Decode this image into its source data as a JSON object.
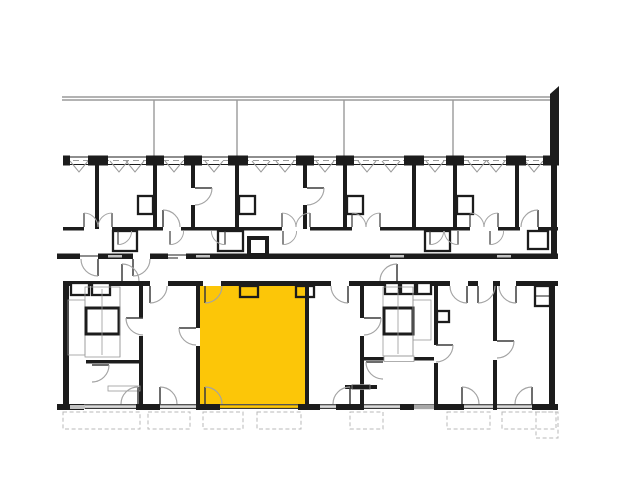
{
  "colors": {
    "wall": "#1c1c1c",
    "line_gray": "#9a9a9a",
    "dash_gray": "#b9b9b9",
    "highlight": "#fcc608",
    "sill": "#c2c2c2",
    "background": "#ffffff"
  },
  "plan": {
    "type": "architectural-floor-plan",
    "upper_building": {
      "units_visible": 8,
      "elements": [
        "balcony-row-with-railing",
        "window-band-with-piers",
        "unit-partition-walls",
        "corridor-wall-with-double-doors",
        "bathroom-cores",
        "rear-wall-with-exits"
      ]
    },
    "lower_building": {
      "units_visible": 7,
      "elements": [
        "entry-doors",
        "stair-core-left",
        "stair-core-right",
        "elevator-shafts",
        "rear-window-wall",
        "terrace-outlines"
      ]
    },
    "highlighted_unit": {
      "id": "unit-3",
      "fill": "#fcc608",
      "selected": true,
      "position": "lower-building-center-left"
    }
  }
}
